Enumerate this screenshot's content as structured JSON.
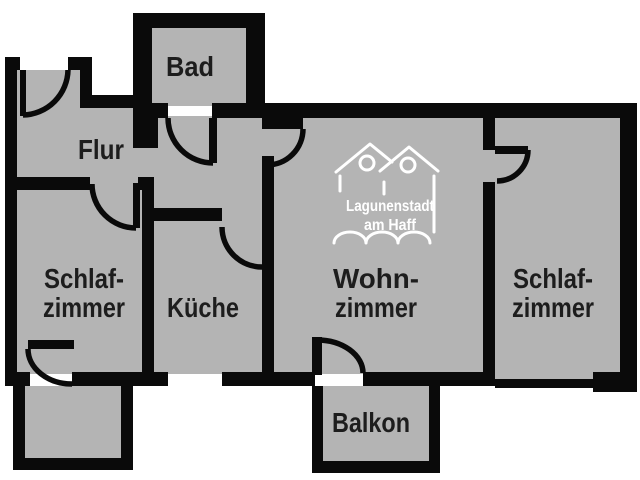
{
  "floorplan": {
    "type": "apartment-floor-plan",
    "colors": {
      "background": "#ffffff",
      "floor": "#b4b4b4",
      "wall": "#0a0a0a",
      "label": "#1d1d1d",
      "logo": "#ffffff"
    },
    "rooms": [
      {
        "id": "bad",
        "label": "Bad"
      },
      {
        "id": "flur",
        "label": "Flur"
      },
      {
        "id": "schlafzimmer-links",
        "line1": "Schlaf-",
        "line2": "zimmer"
      },
      {
        "id": "kueche",
        "label": "Küche"
      },
      {
        "id": "wohnzimmer",
        "line1": "Wohn-",
        "line2": "zimmer"
      },
      {
        "id": "schlafzimmer-rechts",
        "line1": "Schlaf-",
        "line2": "zimmer"
      },
      {
        "id": "balkon",
        "label": "Balkon"
      }
    ],
    "logo": {
      "line1": "Lagunenstadt",
      "line2": "am Haff"
    }
  }
}
